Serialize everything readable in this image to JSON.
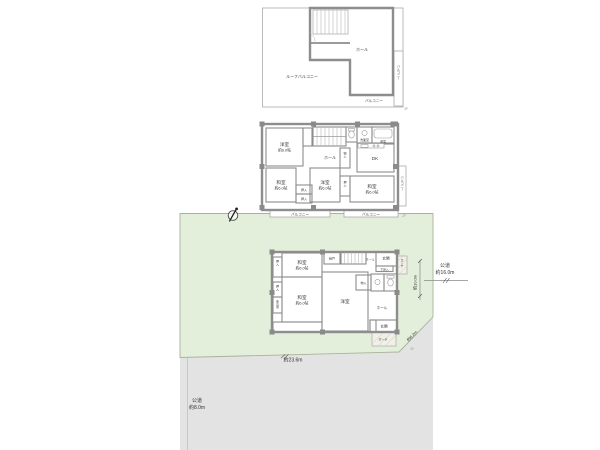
{
  "palette": {
    "tatami_green": "#d9ead1",
    "western_cream": "#f5efd8",
    "dk_peach": "#f8dfc2",
    "bath_blue": "#e8f1f6",
    "plot_green": "#e3efda",
    "road_gray": "#e3e3e3",
    "wall_gray": "#8d8d8d"
  },
  "compass_icon": "north-compass",
  "floor3": {
    "tag": "3F",
    "roof_balcony": "ルーフバルコニー",
    "hall": "ホール",
    "balcony_bottom": "バルコニー",
    "balcony_right": "バルコニー"
  },
  "floor2": {
    "tag": "2F",
    "room_west_tl": {
      "name": "洋室",
      "size": "約6.0帖"
    },
    "room_tatami_ml": {
      "name": "和室",
      "size": "約6.0帖"
    },
    "room_west_c": {
      "name": "洋室",
      "size": "約6.0帖"
    },
    "room_tatami_r": {
      "name": "和室",
      "size": "約6.0帖"
    },
    "dk": "DK",
    "hall": "ホール",
    "washroom": "洗面室",
    "bath": "浴室",
    "closet1": "押入",
    "closet2": "押入",
    "closet3": "押入",
    "storage": "物入",
    "balcony_left": "バルコニー",
    "balcony_right": "バルコニー",
    "balcony_side": "バルコニー"
  },
  "floor1": {
    "tag": "1F",
    "room_tatami_top": {
      "name": "和室",
      "size": "約6.0帖"
    },
    "room_tatami_btm": {
      "name": "和室",
      "size": "約6.0帖"
    },
    "room_west": {
      "name": "洋室"
    },
    "nando": "納戸",
    "hall_top": "ホール",
    "entrance_top": "玄関",
    "shoe_box": "下足入",
    "porch_top": "ポーチ",
    "storage": "物入",
    "hall_right": "ホール",
    "entrance_btm": "玄関",
    "porch_btm": "ポーチ",
    "closet1": "押入",
    "closet2": "押入",
    "tokonoma": "床の間"
  },
  "site": {
    "road_right": {
      "name": "公道",
      "width": "約16.0m"
    },
    "road_bottom": {
      "name": "公道",
      "width": "約8.0m"
    },
    "frontage_bottom": "約23.6m",
    "corner_cut": "約6.2m",
    "side_right": "約10.0m"
  }
}
